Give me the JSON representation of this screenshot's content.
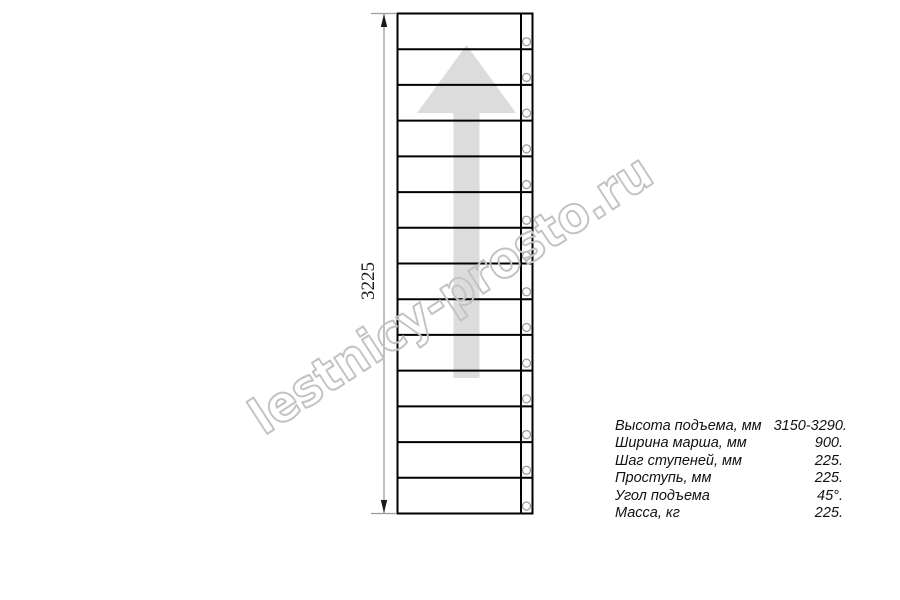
{
  "page": {
    "background": "#ffffff"
  },
  "watermark": {
    "text": "lestnicy-prosto.ru"
  },
  "drawing": {
    "type": "staircase-plan-view",
    "dimension_label": "3225",
    "tread_count": 14,
    "colors": {
      "outline": "#000000",
      "dim_line": "#9c9c9c",
      "dim_arrow": "#1a1a1a",
      "arrow_fill": "#dcdcdc",
      "bolt_stroke": "#9c9c9c",
      "bolt_fill": "#ffffff",
      "watermark_stroke": "#c2c2c2",
      "text": "#1a1a1a"
    }
  },
  "specs": {
    "rows": [
      {
        "label": "Высота подъема, мм",
        "value": "3150-3290."
      },
      {
        "label": "Ширина марша, мм",
        "value": "900."
      },
      {
        "label": "Шаг ступеней, мм",
        "value": "225."
      },
      {
        "label": "Проступь, мм",
        "value": "225."
      },
      {
        "label": "Угол подъема",
        "value": "45°."
      },
      {
        "label": "Масса, кг",
        "value": "225."
      }
    ]
  }
}
